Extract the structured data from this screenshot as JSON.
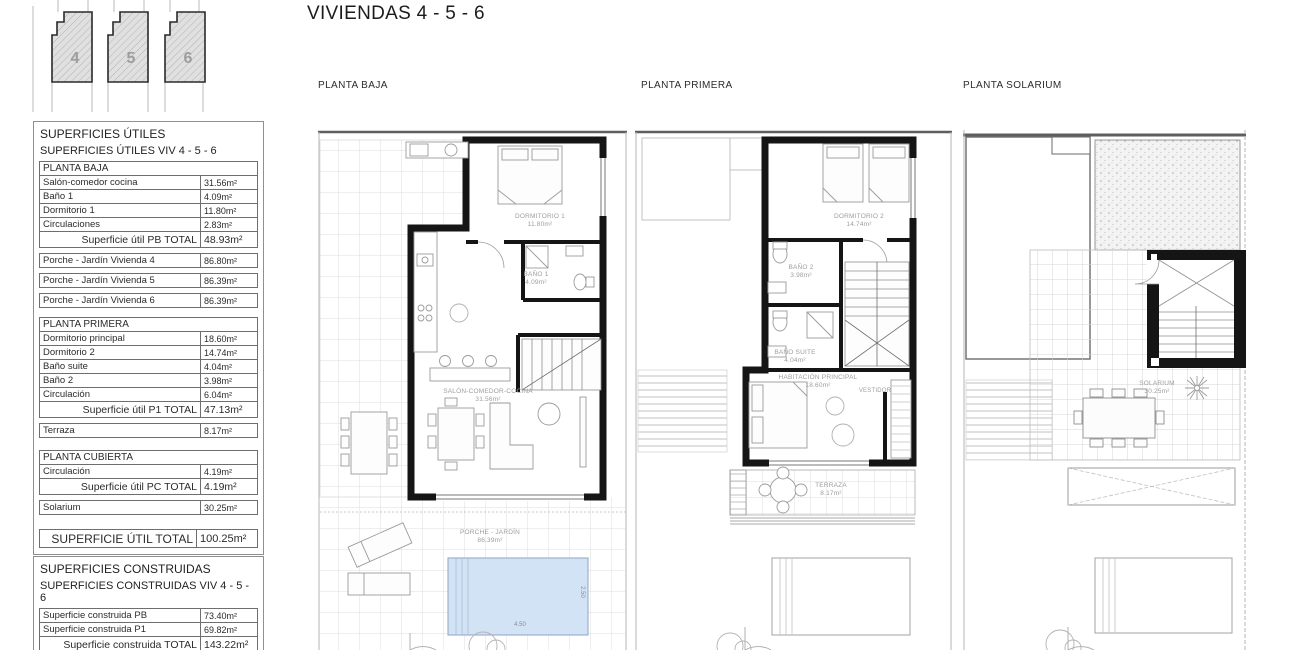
{
  "page": {
    "title": "VIVIENDAS 4 - 5 - 6"
  },
  "site": {
    "units": [
      "4",
      "5",
      "6"
    ]
  },
  "tables": {
    "utiles": {
      "title": "SUPERFICIES ÚTILES",
      "subtitle": "SUPERFICIES ÚTILES VIV 4 - 5 - 6",
      "rows": [
        {
          "label": "PLANTA BAJA",
          "value": ""
        },
        {
          "label": "Salón-comedor cocina",
          "value": "31.56m²"
        },
        {
          "label": "Baño 1",
          "value": "4.09m²"
        },
        {
          "label": "Dormitorio 1",
          "value": "11.80m²"
        },
        {
          "label": "Circulaciones",
          "value": "2.83m²"
        },
        {
          "label": "Superficie útil PB TOTAL",
          "value": "48.93m²"
        },
        {
          "label": "Porche - Jardín Vivienda 4",
          "value": "86.80m²"
        },
        {
          "label": "Porche - Jardín Vivienda 5",
          "value": "86.39m²"
        },
        {
          "label": "Porche - Jardín Vivienda 6",
          "value": "86.39m²"
        },
        {
          "label": "PLANTA PRIMERA",
          "value": ""
        },
        {
          "label": "Dormitorio principal",
          "value": "18.60m²"
        },
        {
          "label": "Dormitorio 2",
          "value": "14.74m²"
        },
        {
          "label": "Baño suite",
          "value": "4.04m²"
        },
        {
          "label": "Baño 2",
          "value": "3.98m²"
        },
        {
          "label": "Circulación",
          "value": "6.04m²"
        },
        {
          "label": "Superficie útil P1 TOTAL",
          "value": "47.13m²"
        },
        {
          "label": "Terraza",
          "value": "8.17m²"
        },
        {
          "label": "PLANTA CUBIERTA",
          "value": ""
        },
        {
          "label": "Circulación",
          "value": "4.19m²"
        },
        {
          "label": "Superficie útil PC TOTAL",
          "value": "4.19m²"
        },
        {
          "label": "Solarium",
          "value": "30.25m²"
        },
        {
          "label": "SUPERFICIE ÚTIL TOTAL",
          "value": "100.25m²"
        }
      ]
    },
    "construidas": {
      "title": "SUPERFICIES CONSTRUIDAS",
      "subtitle": "SUPERFICIES CONSTRUIDAS VIV 4 - 5 - 6",
      "rows": [
        {
          "label": "Superficie construida PB",
          "value": "73.40m²"
        },
        {
          "label": "Superficie construida P1",
          "value": "69.82m²"
        },
        {
          "label": "Superficie construida TOTAL",
          "value": "143.22m²"
        }
      ]
    }
  },
  "plans": {
    "baja": {
      "label": "PLANTA BAJA",
      "rooms": {
        "dormitorio1": {
          "name": "DORMITORIO 1",
          "area": "11.80m²"
        },
        "bano1": {
          "name": "BAÑO 1",
          "area": "4.09m²"
        },
        "salon": {
          "name": "SALÓN-COMEDOR-COCINA",
          "area": "31.56m²"
        },
        "porche": {
          "name": "PORCHE - JARDÍN",
          "area": "86.39m²"
        }
      },
      "pool": {
        "length": "4.50",
        "width": "2.50"
      }
    },
    "primera": {
      "label": "PLANTA PRIMERA",
      "rooms": {
        "dormitorio2": {
          "name": "DORMITORIO 2",
          "area": "14.74m²"
        },
        "bano2": {
          "name": "BAÑO 2",
          "area": "3.98m²"
        },
        "banosuite": {
          "name": "BAÑO SUITE",
          "area": "4.04m²"
        },
        "principal": {
          "name": "HABITACIÓN PRINCIPAL",
          "area": "18.60m²"
        },
        "vestidor": {
          "name": "VESTIDOR"
        },
        "terraza": {
          "name": "TERRAZA",
          "area": "8.17m²"
        }
      }
    },
    "solarium": {
      "label": "PLANTA SOLARIUM",
      "rooms": {
        "solarium": {
          "name": "SOLARIUM",
          "area": "30.25m²"
        }
      }
    }
  }
}
